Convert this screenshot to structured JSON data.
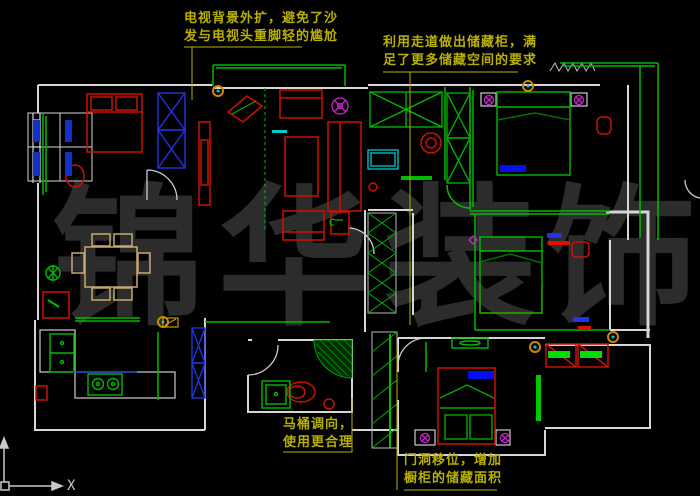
{
  "canvas": {
    "bg": "#000000"
  },
  "watermark": {
    "text": "锦华装饰",
    "chars": [
      "锦",
      "华",
      "装",
      "饰"
    ],
    "color": "#2c2c2c"
  },
  "annotations": {
    "tv": {
      "lines": [
        "电视背景外扩，避免了沙",
        "发与电视头重脚轻的尴尬"
      ]
    },
    "storage": {
      "lines": [
        "利用走道做出储藏柜，满",
        "足了更多储藏空间的要求"
      ]
    },
    "toilet": {
      "lines": [
        "马桶调向，",
        "使用更合理"
      ]
    },
    "door": {
      "lines": [
        "门洞移位，增加",
        "橱柜的储藏面积"
      ]
    }
  },
  "axis": {
    "x_label": "X"
  },
  "colors": {
    "annotation_olive": "#b8b000",
    "wall_white": "#d6d6d6",
    "modified_wall_green": "#00bb00",
    "furniture_red": "#cc1100",
    "wardrobe_blue": "#2233dd",
    "dining_tan": "#c8a870",
    "fixture_cyan": "#00cccc",
    "lamp_magenta": "#cc22cc",
    "symbol_orange": "#cc8800",
    "pillow_blue": "#0011ee"
  },
  "icons": {
    "ucs_axis": "ucs-axis-icon",
    "wardrobe_cross": "wardrobe-x-icon",
    "ceiling_fan": "ceiling-fan-icon",
    "plant": "plant-icon",
    "lamp": "lamp-icon"
  }
}
